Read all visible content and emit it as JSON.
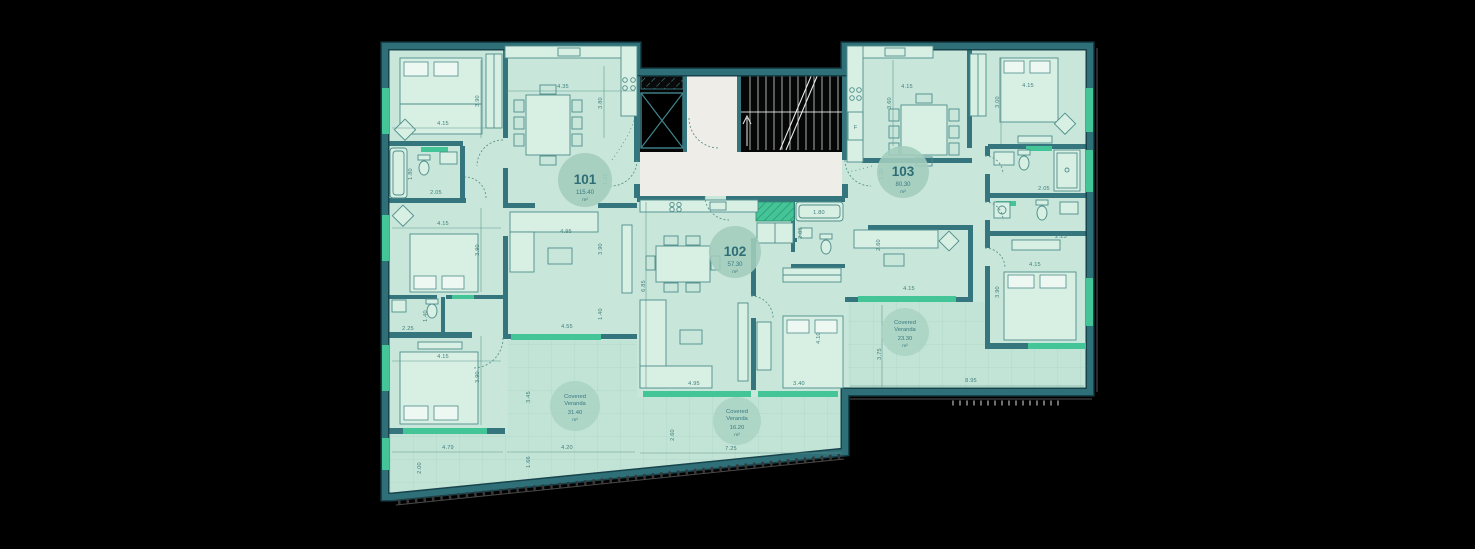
{
  "plan": {
    "units": [
      {
        "number": "101",
        "area": "115.40",
        "area_unit": "m²"
      },
      {
        "number": "102",
        "area": "57.30",
        "area_unit": "m²"
      },
      {
        "number": "103",
        "area": "80.30",
        "area_unit": "m²"
      }
    ],
    "verandas": [
      {
        "label_line1": "Covered",
        "label_line2": "Veranda",
        "area": "31.40",
        "area_unit": "m²"
      },
      {
        "label_line1": "Covered",
        "label_line2": "Veranda",
        "area": "16.20",
        "area_unit": "m²"
      },
      {
        "label_line1": "Covered",
        "label_line2": "Veranda",
        "area": "23.30",
        "area_unit": "m²"
      }
    ],
    "appliance_labels": {
      "fridge": "F"
    },
    "dims": [
      "4.15",
      "3.90",
      "4.35",
      "3.80",
      "1.80",
      "2.05",
      "1.25",
      "4.15",
      "3.90",
      "4.95",
      "3.90",
      "1.40",
      "4.55",
      "2.25",
      "1.40",
      "4.15",
      "3.90",
      "4.79",
      "2.00",
      "3.45",
      "4.20",
      "1.66",
      "2.60",
      "6.85",
      "4.95",
      "3.40",
      "4.10",
      "1.80",
      "2.05",
      "7.25",
      "4.15",
      "3.60",
      "4.15",
      "3.00",
      "1.20",
      "2.05",
      "2.25",
      "4.15",
      "3.90",
      "4.15",
      "2.60",
      "3.75",
      "8.95"
    ]
  },
  "colors": {
    "background": "#000000",
    "wall": "#2f6f78",
    "floor": "#c8e7da",
    "veranda_floor": "#c2e4d6",
    "corridor_floor": "#efede7",
    "window_accent": "#43c598",
    "badge_text": "#2e6d75"
  }
}
